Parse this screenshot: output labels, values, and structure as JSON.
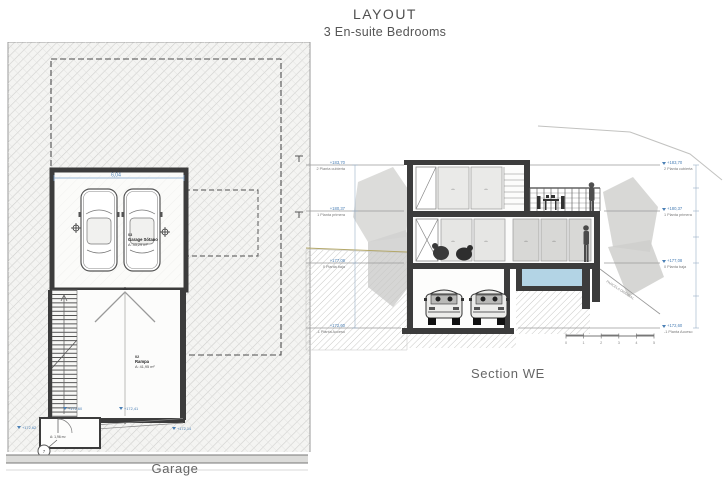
{
  "header": {
    "title": "LAYOUT",
    "subtitle": "3 En-suite Bedrooms"
  },
  "plan": {
    "caption": "Garage",
    "garage_room": {
      "number": "03",
      "name": "Garage Sótano",
      "area": "A: 43,29 m²"
    },
    "ramp_room": {
      "number": "02",
      "name": "Rampa",
      "area": "A: 41,95 m²"
    },
    "entry_area": "A: 1,96 m²",
    "width_dim": "6,04",
    "levels": {
      "stair_top": "+172,60",
      "ramp_top": "+172,41",
      "entry": "+172,62",
      "street": "+172,14"
    },
    "detail_ref": "7"
  },
  "section": {
    "caption": "Section WE",
    "levels": [
      {
        "elevation": "+183,70",
        "name": "2 Planta cubierta"
      },
      {
        "elevation": "+180,37",
        "name": "1 Planta primera"
      },
      {
        "elevation": "+177,08",
        "name": "0 Planta baja"
      },
      {
        "elevation": "+172,60",
        "name": "-1 Planta Acceso"
      }
    ],
    "annotations": {
      "parcela": "PARCELA ORIGINAL"
    },
    "scale_ticks": [
      "0",
      "1",
      "2",
      "3",
      "4",
      "5"
    ]
  },
  "colors": {
    "dim_blue": "#4a7fb5",
    "wall": "#3c3c3c",
    "pool": "#b3d4e5"
  }
}
